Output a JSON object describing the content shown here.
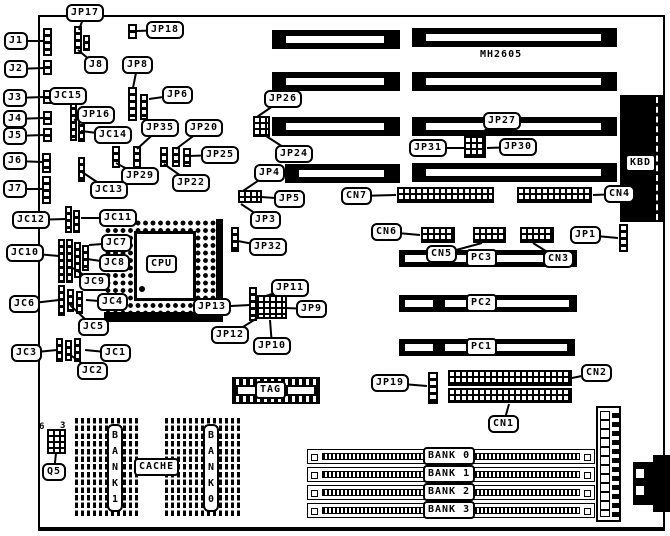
{
  "colors": {
    "ink": "#000000",
    "background": "#ffffff"
  },
  "plain": {
    "part_number": "MH2605",
    "q5_pin_left": "6",
    "q5_pin_right": "3"
  },
  "callouts": [
    {
      "id": "j1",
      "label": "J1",
      "x": 4,
      "y": 32,
      "tx": 44,
      "ty": 41
    },
    {
      "id": "j2",
      "label": "J2",
      "x": 4,
      "y": 60,
      "tx": 44,
      "ty": 68
    },
    {
      "id": "j3",
      "label": "J3",
      "x": 3,
      "y": 89,
      "tx": 44,
      "ty": 97
    },
    {
      "id": "j4",
      "label": "J4",
      "x": 3,
      "y": 110,
      "tx": 44,
      "ty": 118
    },
    {
      "id": "j5",
      "label": "J5",
      "x": 3,
      "y": 127,
      "tx": 44,
      "ty": 135
    },
    {
      "id": "j6",
      "label": "J6",
      "x": 3,
      "y": 152,
      "tx": 43,
      "ty": 162
    },
    {
      "id": "j7",
      "label": "J7",
      "x": 3,
      "y": 180,
      "tx": 43,
      "ty": 189
    },
    {
      "id": "jc12",
      "label": "JC12",
      "x": 12,
      "y": 211,
      "tx": 66,
      "ty": 219
    },
    {
      "id": "jc10",
      "label": "JC10",
      "x": 6,
      "y": 244,
      "tx": 59,
      "ty": 256
    },
    {
      "id": "jc6",
      "label": "JC6",
      "x": 9,
      "y": 295,
      "tx": 59,
      "ty": 300
    },
    {
      "id": "jc3",
      "label": "JC3",
      "x": 11,
      "y": 344,
      "tx": 57,
      "ty": 350
    },
    {
      "id": "jp17",
      "label": "JP17",
      "x": 66,
      "y": 4,
      "tx": 79,
      "ty": 30
    },
    {
      "id": "jp18",
      "label": "JP18",
      "x": 146,
      "y": 21,
      "tx": 137,
      "ty": 31
    },
    {
      "id": "j8",
      "label": "J8",
      "x": 84,
      "y": 56,
      "tx": 78,
      "ty": 50
    },
    {
      "id": "jp8",
      "label": "JP8",
      "x": 122,
      "y": 56,
      "tx": 133,
      "ty": 88
    },
    {
      "id": "jp6",
      "label": "JP6",
      "x": 162,
      "y": 86,
      "tx": 149,
      "ty": 99
    },
    {
      "id": "jc15",
      "label": "JC15",
      "x": 49,
      "y": 87,
      "tx": 73,
      "ty": 103
    },
    {
      "id": "jp16",
      "label": "JP16",
      "x": 77,
      "y": 106,
      "tx": 74,
      "ty": 120
    },
    {
      "id": "jc14",
      "label": "JC14",
      "x": 94,
      "y": 126,
      "tx": 81,
      "ty": 131
    },
    {
      "id": "jp35",
      "label": "JP35",
      "x": 141,
      "y": 119,
      "tx": 137,
      "ty": 149
    },
    {
      "id": "jp20",
      "label": "JP20",
      "x": 185,
      "y": 119,
      "tx": 176,
      "ty": 149
    },
    {
      "id": "jp25",
      "label": "JP25",
      "x": 201,
      "y": 146,
      "tx": 188,
      "ty": 156
    },
    {
      "id": "jp29",
      "label": "JP29",
      "x": 121,
      "y": 167,
      "tx": 116,
      "ty": 163
    },
    {
      "id": "jp22",
      "label": "JP22",
      "x": 172,
      "y": 174,
      "tx": 164,
      "ty": 164
    },
    {
      "id": "jc13",
      "label": "JC13",
      "x": 90,
      "y": 181,
      "tx": 82,
      "ty": 172
    },
    {
      "id": "jc11",
      "label": "JC11",
      "x": 99,
      "y": 209,
      "tx": 81,
      "ty": 218
    },
    {
      "id": "jc7",
      "label": "JC7",
      "x": 101,
      "y": 234,
      "tx": 89,
      "ty": 245
    },
    {
      "id": "jc8",
      "label": "JC8",
      "x": 99,
      "y": 254,
      "tx": 87,
      "ty": 259
    },
    {
      "id": "jc9",
      "label": "JC9",
      "x": 79,
      "y": 273,
      "tx": 73,
      "ty": 268
    },
    {
      "id": "jc4",
      "label": "JC4",
      "x": 97,
      "y": 293,
      "tx": 86,
      "ty": 300
    },
    {
      "id": "jc5",
      "label": "JC5",
      "x": 78,
      "y": 318,
      "tx": 70,
      "ty": 305
    },
    {
      "id": "jc1",
      "label": "JC1",
      "x": 100,
      "y": 344,
      "tx": 85,
      "ty": 350
    },
    {
      "id": "jc2",
      "label": "JC2",
      "x": 77,
      "y": 362,
      "tx": 69,
      "ty": 354
    },
    {
      "id": "jp13",
      "label": "JP13",
      "x": 193,
      "y": 298,
      "tx": 250,
      "ty": 305
    },
    {
      "id": "jp11",
      "label": "JP11",
      "x": 271,
      "y": 279,
      "tx": 263,
      "ty": 297
    },
    {
      "id": "jp9",
      "label": "JP9",
      "x": 296,
      "y": 300,
      "tx": 285,
      "ty": 308
    },
    {
      "id": "jp12",
      "label": "JP12",
      "x": 211,
      "y": 326,
      "tx": 259,
      "ty": 317
    },
    {
      "id": "jp10",
      "label": "JP10",
      "x": 253,
      "y": 337,
      "tx": 270,
      "ty": 320
    },
    {
      "id": "jp32",
      "label": "JP32",
      "x": 249,
      "y": 238,
      "tx": 238,
      "ty": 241
    },
    {
      "id": "jp4",
      "label": "JP4",
      "x": 254,
      "y": 164,
      "tx": 243,
      "ty": 191
    },
    {
      "id": "jp5",
      "label": "JP5",
      "x": 274,
      "y": 190,
      "tx": 261,
      "ty": 197
    },
    {
      "id": "jp3",
      "label": "JP3",
      "x": 250,
      "y": 211,
      "tx": 241,
      "ty": 204
    },
    {
      "id": "jp26",
      "label": "JP26",
      "x": 264,
      "y": 90,
      "tx": 257,
      "ty": 117
    },
    {
      "id": "jp24",
      "label": "JP24",
      "x": 275,
      "y": 145,
      "tx": 266,
      "ty": 136
    },
    {
      "id": "jp27",
      "label": "JP27",
      "x": 483,
      "y": 112,
      "tx": 473,
      "ty": 137
    },
    {
      "id": "jp31",
      "label": "JP31",
      "x": 409,
      "y": 139,
      "tx": 464,
      "ty": 148
    },
    {
      "id": "jp30",
      "label": "JP30",
      "x": 499,
      "y": 138,
      "tx": 487,
      "ty": 148
    },
    {
      "id": "cn7",
      "label": "CN7",
      "x": 341,
      "y": 187,
      "tx": 396,
      "ty": 195
    },
    {
      "id": "cn4",
      "label": "CN4",
      "x": 604,
      "y": 185,
      "tx": 593,
      "ty": 195
    },
    {
      "id": "cn6",
      "label": "CN6",
      "x": 371,
      "y": 223,
      "tx": 420,
      "ty": 235
    },
    {
      "id": "cn5",
      "label": "CN5",
      "x": 426,
      "y": 245,
      "tx": 482,
      "ty": 243
    },
    {
      "id": "cn3",
      "label": "CN3",
      "x": 543,
      "y": 250,
      "tx": 533,
      "ty": 243
    },
    {
      "id": "jp1",
      "label": "JP1",
      "x": 570,
      "y": 226,
      "tx": 618,
      "ty": 238
    },
    {
      "id": "jp19",
      "label": "JP19",
      "x": 371,
      "y": 374,
      "tx": 427,
      "ty": 386
    },
    {
      "id": "cn2",
      "label": "CN2",
      "x": 581,
      "y": 364,
      "tx": 572,
      "ty": 378
    },
    {
      "id": "cn1",
      "label": "CN1",
      "x": 488,
      "y": 415,
      "tx": 509,
      "ty": 404
    },
    {
      "id": "q5",
      "label": "Q5",
      "x": 42,
      "y": 463,
      "tx": 56,
      "ty": 453
    }
  ],
  "chip_boxes": [
    {
      "id": "cpu",
      "label": "CPU",
      "x": 146,
      "y": 255
    },
    {
      "id": "tag",
      "label": "TAG",
      "x": 255,
      "y": 381
    },
    {
      "id": "cache",
      "label": "CACHE",
      "x": 134,
      "y": 458
    },
    {
      "id": "kbd",
      "label": "KBD",
      "x": 625,
      "y": 154
    },
    {
      "id": "pc3",
      "label": "PC3",
      "x": 466,
      "y": 249
    },
    {
      "id": "pc2",
      "label": "PC2",
      "x": 466,
      "y": 294
    },
    {
      "id": "pc1",
      "label": "PC1",
      "x": 466,
      "y": 338
    },
    {
      "id": "bank0",
      "label": "BANK 0",
      "x": 423,
      "y": 447
    },
    {
      "id": "bank1",
      "label": "BANK 1",
      "x": 423,
      "y": 465
    },
    {
      "id": "bank2",
      "label": "BANK 2",
      "x": 423,
      "y": 483
    },
    {
      "id": "bank3",
      "label": "BANK 3",
      "x": 423,
      "y": 501
    }
  ],
  "vertical_boxes": [
    {
      "id": "cache-bank1",
      "label": "BANK1",
      "x": 107,
      "y": 424
    },
    {
      "id": "cache-bank0",
      "label": "BANK0",
      "x": 203,
      "y": 424
    }
  ]
}
